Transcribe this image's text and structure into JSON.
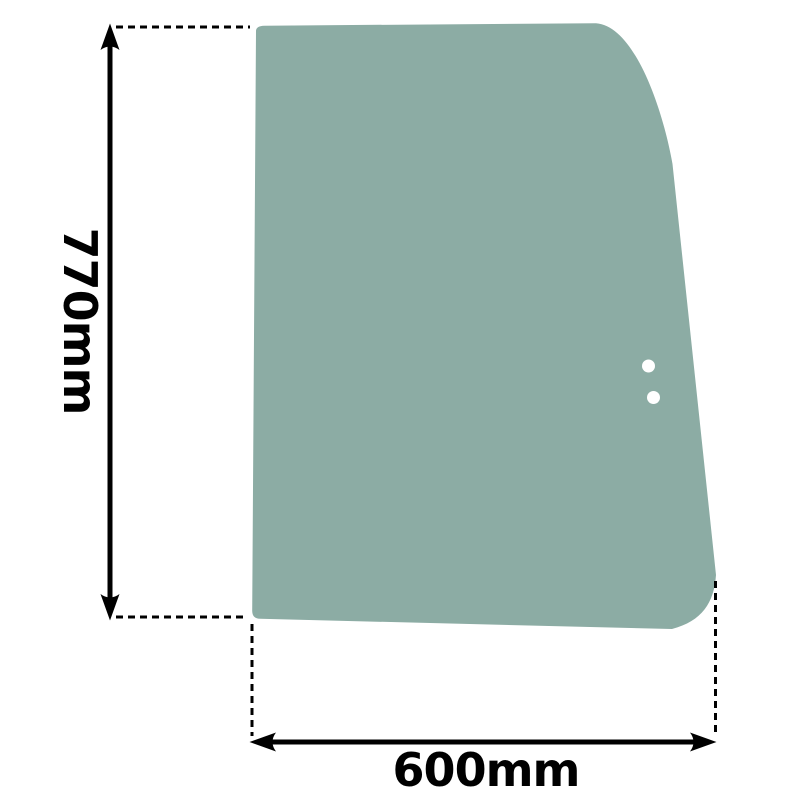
{
  "diagram": {
    "title": "glass panel dimension drawing",
    "background_color": "#ffffff",
    "line_color": "#000000"
  },
  "glass": {
    "fill_color": "#8CACA4",
    "hole_fill_color": "#ffffff",
    "hole_count": 2
  },
  "dimensions": {
    "height": {
      "label": "770mm",
      "value": 770,
      "unit": "mm"
    },
    "width": {
      "label": "600mm",
      "value": 600,
      "unit": "mm"
    }
  },
  "icons": {
    "arrowhead_up": "filled-triangle-up",
    "arrowhead_down": "filled-triangle-down",
    "arrowhead_left": "filled-triangle-left",
    "arrowhead_right": "filled-triangle-right"
  }
}
